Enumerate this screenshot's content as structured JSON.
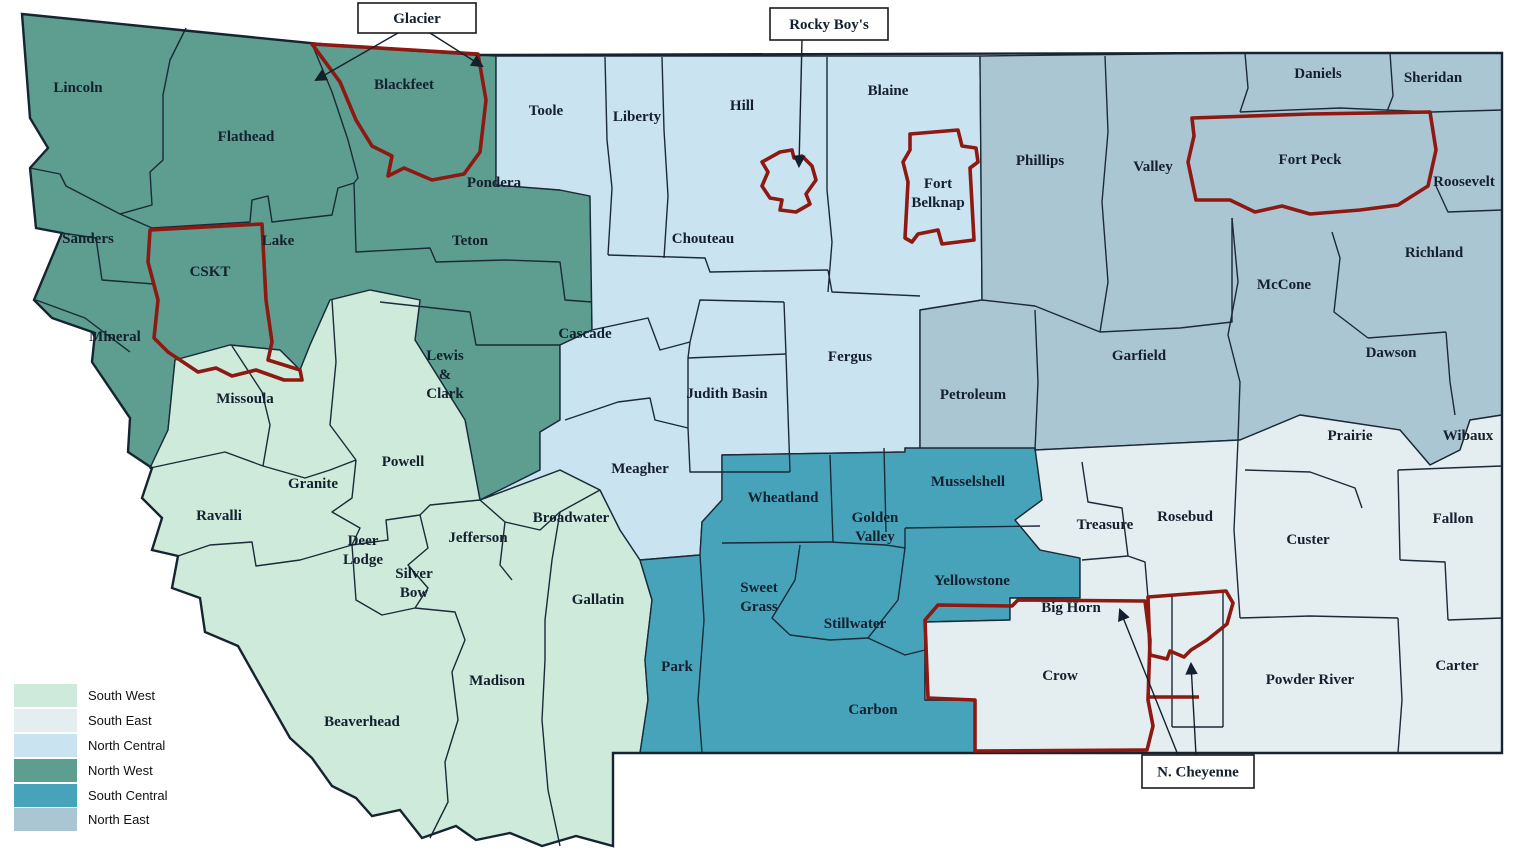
{
  "colors": {
    "south_west": "#cdeadb",
    "south_east": "#e4edf0",
    "north_central": "#c9e3f0",
    "north_west": "#5d9e91",
    "south_central": "#47a3ba",
    "north_east": "#abc6d3",
    "reservation_outline": "#8e1812",
    "county_border": "#1b2a38",
    "state_outline": "#16242f",
    "label_text": "#14202e",
    "background": "#ffffff"
  },
  "legend": {
    "items": [
      {
        "label": "South West",
        "region": "south_west"
      },
      {
        "label": "South East",
        "region": "south_east"
      },
      {
        "label": "North Central",
        "region": "north_central"
      },
      {
        "label": "North West",
        "region": "north_west"
      },
      {
        "label": "South Central",
        "region": "south_central"
      },
      {
        "label": "North East",
        "region": "north_east"
      }
    ]
  },
  "map": {
    "labels": [
      {
        "id": "lincoln",
        "type": "county",
        "region": "north_west",
        "x": 78,
        "y": 92,
        "lines": [
          "Lincoln"
        ]
      },
      {
        "id": "flathead",
        "type": "county",
        "region": "north_west",
        "x": 246,
        "y": 141,
        "lines": [
          "Flathead"
        ]
      },
      {
        "id": "sanders",
        "type": "county",
        "region": "north_west",
        "x": 88,
        "y": 243,
        "lines": [
          "Sanders"
        ]
      },
      {
        "id": "lake",
        "type": "county",
        "region": "north_west",
        "x": 278,
        "y": 245,
        "lines": [
          "Lake"
        ]
      },
      {
        "id": "mineral",
        "type": "county",
        "region": "north_west",
        "x": 115,
        "y": 341,
        "lines": [
          "Mineral"
        ]
      },
      {
        "id": "pondera",
        "type": "county",
        "region": "north_west",
        "x": 494,
        "y": 187,
        "lines": [
          "Pondera"
        ]
      },
      {
        "id": "teton",
        "type": "county",
        "region": "north_west",
        "x": 470,
        "y": 245,
        "lines": [
          "Teton"
        ]
      },
      {
        "id": "lewis-and-clark",
        "type": "county",
        "region": "north_west",
        "x": 445,
        "y": 360,
        "lines": [
          "Lewis",
          "&",
          "Clark"
        ]
      },
      {
        "id": "blackfeet",
        "type": "reservation",
        "region": "north_west",
        "x": 404,
        "y": 89,
        "lines": [
          "Blackfeet"
        ]
      },
      {
        "id": "cskt",
        "type": "reservation",
        "region": "north_west",
        "x": 210,
        "y": 276,
        "lines": [
          "CSKT"
        ]
      },
      {
        "id": "missoula",
        "type": "county",
        "region": "south_west",
        "x": 245,
        "y": 403,
        "lines": [
          "Missoula"
        ]
      },
      {
        "id": "ravalli",
        "type": "county",
        "region": "south_west",
        "x": 219,
        "y": 520,
        "lines": [
          "Ravalli"
        ]
      },
      {
        "id": "granite",
        "type": "county",
        "region": "south_west",
        "x": 313,
        "y": 488,
        "lines": [
          "Granite"
        ]
      },
      {
        "id": "powell",
        "type": "county",
        "region": "south_west",
        "x": 403,
        "y": 466,
        "lines": [
          "Powell"
        ]
      },
      {
        "id": "deer-lodge",
        "type": "county",
        "region": "south_west",
        "x": 363,
        "y": 545,
        "lines": [
          "Deer",
          "Lodge"
        ]
      },
      {
        "id": "silver-bow",
        "type": "county",
        "region": "south_west",
        "x": 414,
        "y": 578,
        "lines": [
          "Silver",
          "Bow"
        ]
      },
      {
        "id": "jefferson",
        "type": "county",
        "region": "south_west",
        "x": 478,
        "y": 542,
        "lines": [
          "Jefferson"
        ]
      },
      {
        "id": "broadwater",
        "type": "county",
        "region": "south_west",
        "x": 571,
        "y": 522,
        "lines": [
          "Broadwater"
        ]
      },
      {
        "id": "gallatin",
        "type": "county",
        "region": "south_west",
        "x": 598,
        "y": 604,
        "lines": [
          "Gallatin"
        ]
      },
      {
        "id": "madison",
        "type": "county",
        "region": "south_west",
        "x": 497,
        "y": 685,
        "lines": [
          "Madison"
        ]
      },
      {
        "id": "beaverhead",
        "type": "county",
        "region": "south_west",
        "x": 362,
        "y": 726,
        "lines": [
          "Beaverhead"
        ]
      },
      {
        "id": "toole",
        "type": "county",
        "region": "north_central",
        "x": 546,
        "y": 115,
        "lines": [
          "Toole"
        ]
      },
      {
        "id": "liberty",
        "type": "county",
        "region": "north_central",
        "x": 637,
        "y": 121,
        "lines": [
          "Liberty"
        ]
      },
      {
        "id": "hill",
        "type": "county",
        "region": "north_central",
        "x": 742,
        "y": 110,
        "lines": [
          "Hill"
        ]
      },
      {
        "id": "blaine",
        "type": "county",
        "region": "north_central",
        "x": 888,
        "y": 95,
        "lines": [
          "Blaine"
        ]
      },
      {
        "id": "chouteau",
        "type": "county",
        "region": "north_central",
        "x": 703,
        "y": 243,
        "lines": [
          "Chouteau"
        ]
      },
      {
        "id": "cascade",
        "type": "county",
        "region": "north_central",
        "x": 585,
        "y": 338,
        "lines": [
          "Cascade"
        ]
      },
      {
        "id": "judith-basin",
        "type": "county",
        "region": "north_central",
        "x": 727,
        "y": 398,
        "lines": [
          "Judith Basin"
        ]
      },
      {
        "id": "fergus",
        "type": "county",
        "region": "north_central",
        "x": 850,
        "y": 361,
        "lines": [
          "Fergus"
        ]
      },
      {
        "id": "meagher",
        "type": "county",
        "region": "north_central",
        "x": 640,
        "y": 473,
        "lines": [
          "Meagher"
        ]
      },
      {
        "id": "phillips",
        "type": "county",
        "region": "north_east",
        "x": 1040,
        "y": 165,
        "lines": [
          "Phillips"
        ]
      },
      {
        "id": "valley",
        "type": "county",
        "region": "north_east",
        "x": 1153,
        "y": 171,
        "lines": [
          "Valley"
        ]
      },
      {
        "id": "daniels",
        "type": "county",
        "region": "north_east",
        "x": 1318,
        "y": 78,
        "lines": [
          "Daniels"
        ]
      },
      {
        "id": "sheridan",
        "type": "county",
        "region": "north_east",
        "x": 1433,
        "y": 82,
        "lines": [
          "Sheridan"
        ]
      },
      {
        "id": "fort-peck",
        "type": "reservation",
        "region": "north_east",
        "x": 1310,
        "y": 164,
        "lines": [
          "Fort Peck"
        ]
      },
      {
        "id": "roosevelt",
        "type": "county",
        "region": "north_east",
        "x": 1464,
        "y": 186,
        "lines": [
          "Roosevelt"
        ]
      },
      {
        "id": "richland",
        "type": "county",
        "region": "north_east",
        "x": 1434,
        "y": 257,
        "lines": [
          "Richland"
        ]
      },
      {
        "id": "mccone",
        "type": "county",
        "region": "north_east",
        "x": 1284,
        "y": 289,
        "lines": [
          "McCone"
        ]
      },
      {
        "id": "garfield",
        "type": "county",
        "region": "north_east",
        "x": 1139,
        "y": 360,
        "lines": [
          "Garfield"
        ]
      },
      {
        "id": "dawson",
        "type": "county",
        "region": "north_east",
        "x": 1391,
        "y": 357,
        "lines": [
          "Dawson"
        ]
      },
      {
        "id": "petroleum",
        "type": "county",
        "region": "north_east",
        "x": 973,
        "y": 399,
        "lines": [
          "Petroleum"
        ]
      },
      {
        "id": "fort-belknap",
        "type": "reservation",
        "region": "north_central",
        "x": 938,
        "y": 188,
        "lines": [
          "Fort",
          "Belknap"
        ]
      },
      {
        "id": "wheatland",
        "type": "county",
        "region": "south_central",
        "x": 783,
        "y": 502,
        "lines": [
          "Wheatland"
        ]
      },
      {
        "id": "golden-valley",
        "type": "county",
        "region": "south_central",
        "x": 875,
        "y": 522,
        "lines": [
          "Golden",
          "Valley"
        ]
      },
      {
        "id": "musselshell",
        "type": "county",
        "region": "south_central",
        "x": 968,
        "y": 486,
        "lines": [
          "Musselshell"
        ]
      },
      {
        "id": "yellowstone",
        "type": "county",
        "region": "south_central",
        "x": 972,
        "y": 585,
        "lines": [
          "Yellowstone"
        ]
      },
      {
        "id": "sweet-grass",
        "type": "county",
        "region": "south_central",
        "x": 759,
        "y": 592,
        "lines": [
          "Sweet",
          "Grass"
        ]
      },
      {
        "id": "stillwater",
        "type": "county",
        "region": "south_central",
        "x": 855,
        "y": 628,
        "lines": [
          "Stillwater"
        ]
      },
      {
        "id": "park",
        "type": "county",
        "region": "south_central",
        "x": 677,
        "y": 671,
        "lines": [
          "Park"
        ]
      },
      {
        "id": "carbon",
        "type": "county",
        "region": "south_central",
        "x": 873,
        "y": 714,
        "lines": [
          "Carbon"
        ]
      },
      {
        "id": "prairie",
        "type": "county",
        "region": "south_east",
        "x": 1350,
        "y": 440,
        "lines": [
          "Prairie"
        ]
      },
      {
        "id": "wibaux",
        "type": "county",
        "region": "south_east",
        "x": 1468,
        "y": 440,
        "lines": [
          "Wibaux"
        ]
      },
      {
        "id": "fallon",
        "type": "county",
        "region": "south_east",
        "x": 1453,
        "y": 523,
        "lines": [
          "Fallon"
        ]
      },
      {
        "id": "custer",
        "type": "county",
        "region": "south_east",
        "x": 1308,
        "y": 544,
        "lines": [
          "Custer"
        ]
      },
      {
        "id": "powder-river",
        "type": "county",
        "region": "south_east",
        "x": 1310,
        "y": 684,
        "lines": [
          "Powder River"
        ]
      },
      {
        "id": "carter",
        "type": "county",
        "region": "south_east",
        "x": 1457,
        "y": 670,
        "lines": [
          "Carter"
        ]
      },
      {
        "id": "rosebud",
        "type": "county",
        "region": "south_east",
        "x": 1185,
        "y": 521,
        "lines": [
          "Rosebud"
        ]
      },
      {
        "id": "treasure",
        "type": "county",
        "region": "south_east",
        "x": 1105,
        "y": 529,
        "lines": [
          "Treasure"
        ]
      },
      {
        "id": "big-horn",
        "type": "county",
        "region": "south_east",
        "x": 1071,
        "y": 612,
        "lines": [
          "Big Horn"
        ]
      },
      {
        "id": "crow",
        "type": "reservation",
        "region": "south_east",
        "x": 1060,
        "y": 680,
        "lines": [
          "Crow"
        ]
      }
    ],
    "callouts": [
      {
        "id": "glacier",
        "label": "Glacier"
      },
      {
        "id": "rocky_boys",
        "label": "Rocky Boy's"
      },
      {
        "id": "n_cheyenne",
        "label": "N. Cheyenne"
      }
    ]
  }
}
